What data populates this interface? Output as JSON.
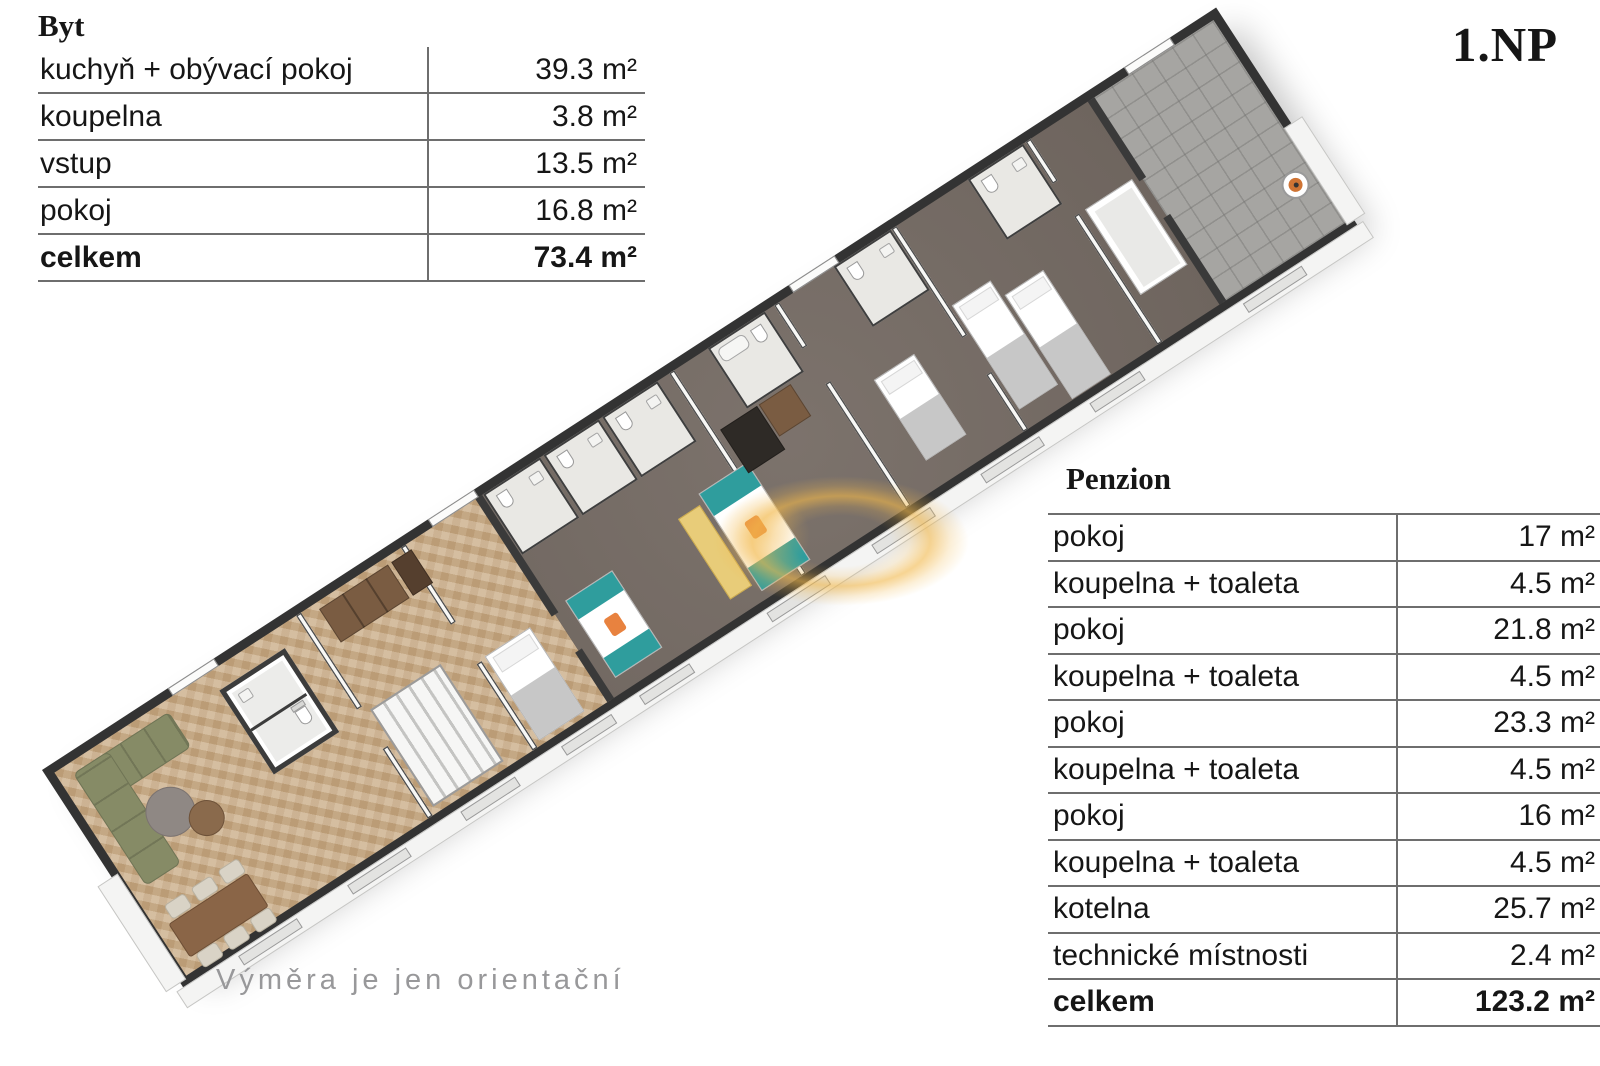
{
  "floor_label": "1.NP",
  "disclaimer": "Výměra je jen orientační",
  "byt_table": {
    "title": "Byt",
    "rows": [
      {
        "label": "kuchyň + obývací pokoj",
        "value": "39.3 m²",
        "bold": false
      },
      {
        "label": "koupelna",
        "value": "3.8 m²",
        "bold": false
      },
      {
        "label": "vstup",
        "value": "13.5 m²",
        "bold": false
      },
      {
        "label": "pokoj",
        "value": "16.8 m²",
        "bold": false
      },
      {
        "label": "celkem",
        "value": "73.4 m²",
        "bold": true
      }
    ]
  },
  "penzion_table": {
    "title": "Penzion",
    "rows": [
      {
        "label": "pokoj",
        "value": "17 m²",
        "bold": false
      },
      {
        "label": "koupelna + toaleta",
        "value": "4.5 m²",
        "bold": false
      },
      {
        "label": "pokoj",
        "value": "21.8 m²",
        "bold": false
      },
      {
        "label": "koupelna + toaleta",
        "value": "4.5 m²",
        "bold": false
      },
      {
        "label": "pokoj",
        "value": "23.3 m²",
        "bold": false
      },
      {
        "label": "koupelna + toaleta",
        "value": "4.5 m²",
        "bold": false
      },
      {
        "label": "pokoj",
        "value": "16 m²",
        "bold": false
      },
      {
        "label": "koupelna + toaleta",
        "value": "4.5 m²",
        "bold": false
      },
      {
        "label": "kotelna",
        "value": "25.7 m²",
        "bold": false
      },
      {
        "label": "technické místnosti",
        "value": "2.4 m²",
        "bold": false
      },
      {
        "label": "celkem",
        "value": "123.2 m²",
        "bold": true
      }
    ]
  },
  "colors": {
    "accent_glow": "#f2b84a",
    "wood_floor": "#c9ab85",
    "pension_floor": "#756b64",
    "tile_floor": "#a6a5a2",
    "sofa_green": "#868b66"
  }
}
